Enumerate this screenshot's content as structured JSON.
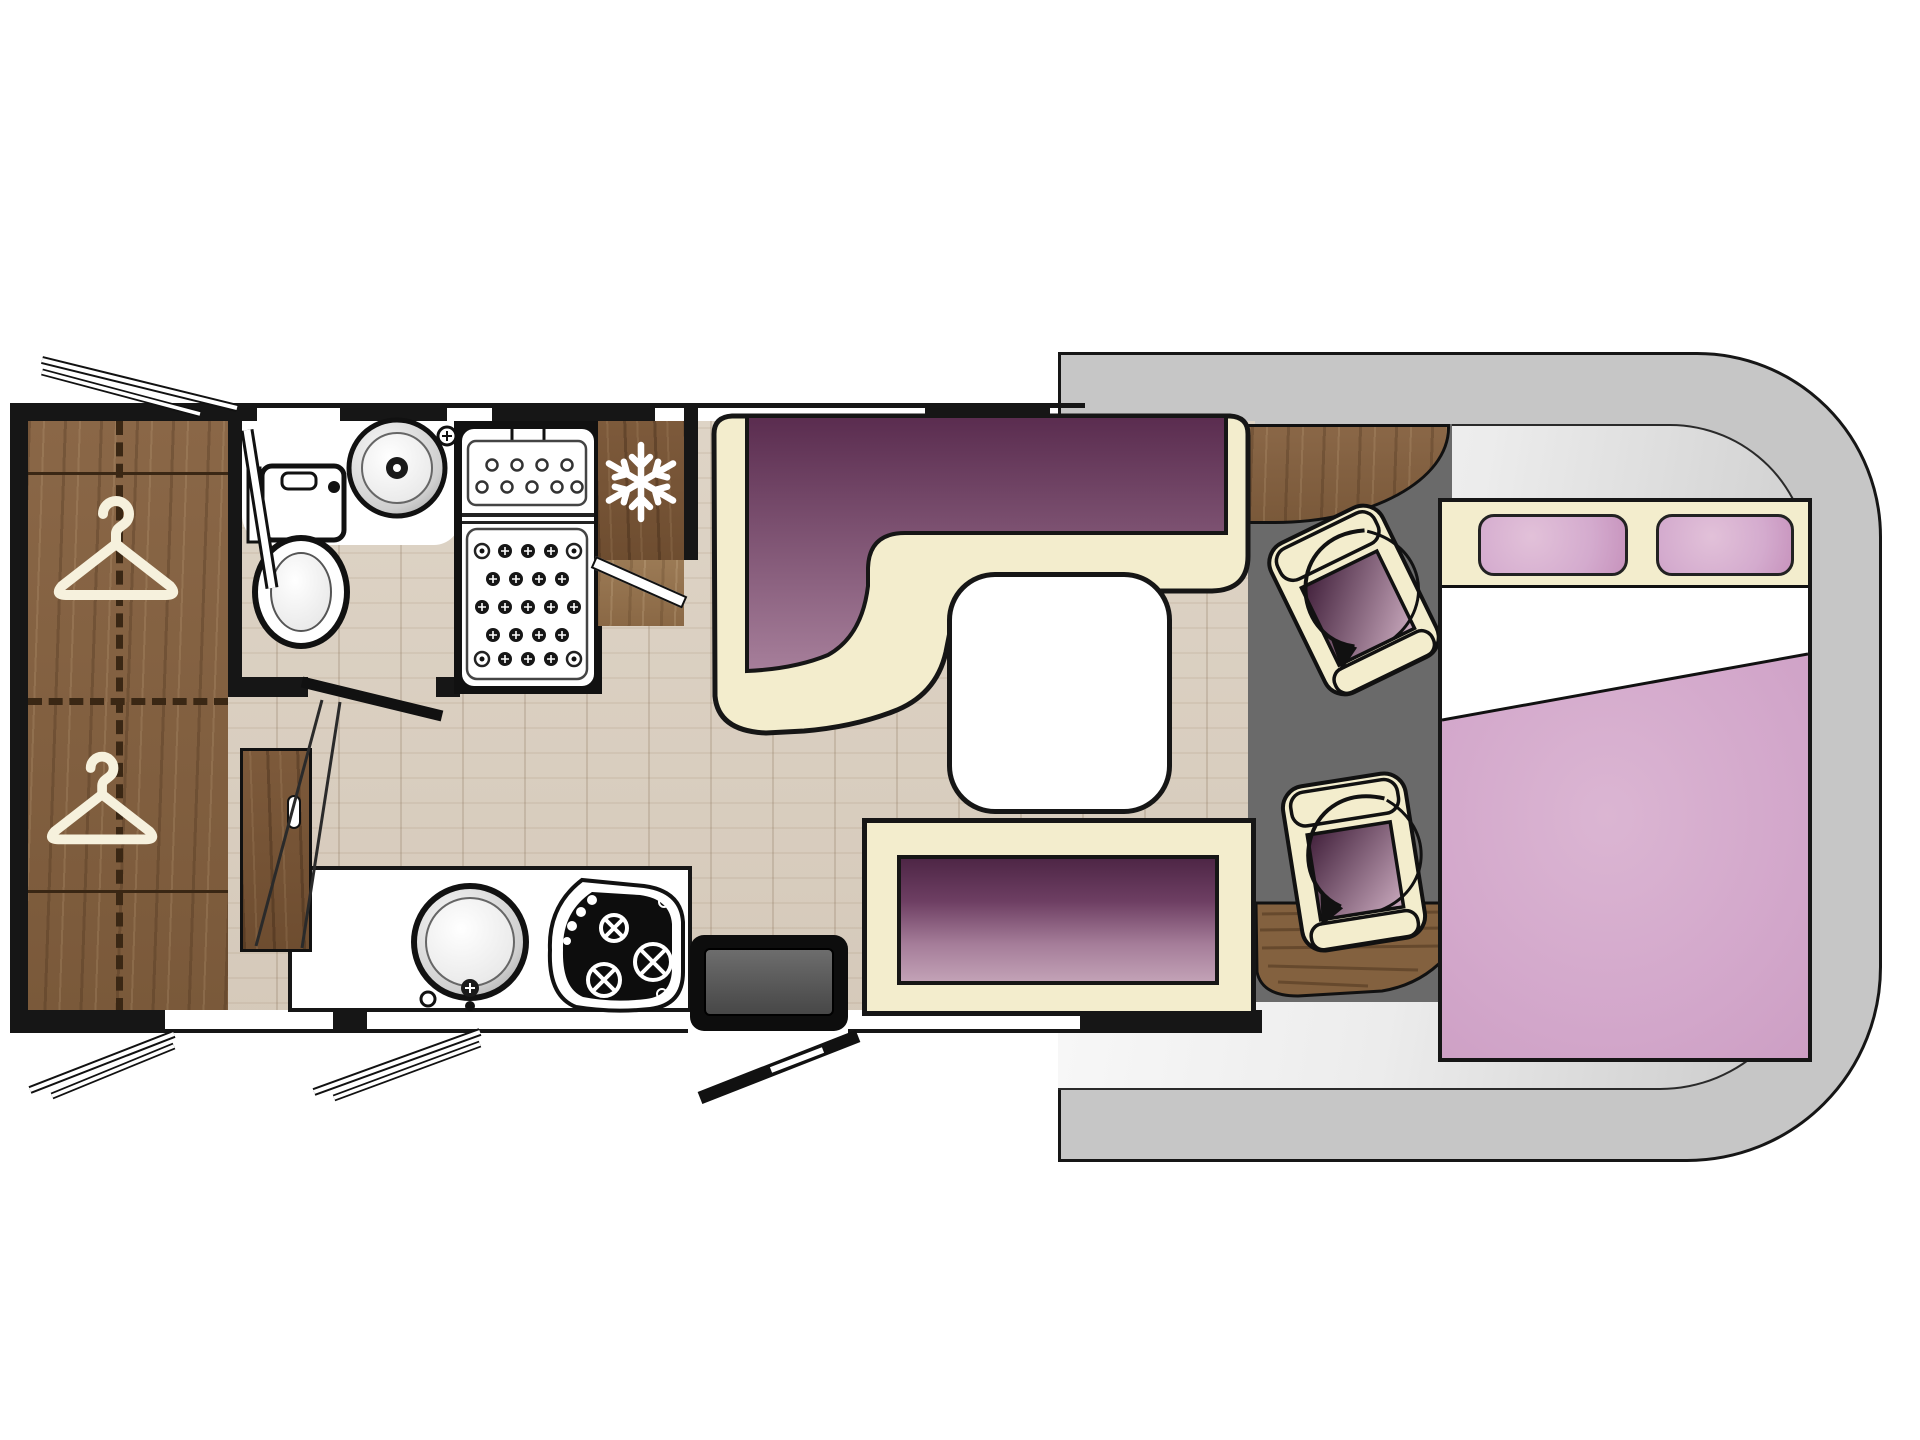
{
  "diagram": {
    "kind": "motorhome-floorplan",
    "view": "top-down",
    "cab_position": "right",
    "visible_text": "none"
  },
  "palette": {
    "outline": "#161616",
    "wood": "#8a6747",
    "woodDark": "#7a593a",
    "woodLight": "#9b7a55",
    "floor": "#d9cfc1",
    "cream": "#f3edcd",
    "purpleDark": "#55294b",
    "purpleMid": "#7d4a6e",
    "purpleLight": "#b793a9",
    "benchDark": "#4e2646",
    "benchLight": "#c2a1b6",
    "cabBody": "#c6c6c6",
    "cabBodyInner": "#f4f4f4",
    "cabFloor": "#6a6a6a",
    "stepGrey": "#575757",
    "bedPink": "#d4a9cc",
    "bedPinkLight": "#e2c1d9",
    "pillowPink": "#d4abce",
    "white": "#ffffff"
  },
  "zones": {
    "wardrobe": {
      "name": "Wardrobe with two hanging rails",
      "icon": "clothes-hanger"
    },
    "bathroom": {
      "name": "Washroom with toilet and round basin"
    },
    "shower": {
      "name": "Shower cubicle with drain tray"
    },
    "fridge": {
      "name": "Refrigerator",
      "icon": "snowflake"
    },
    "kitchen": {
      "name": "Kitchen counter with round sink and 3-burner hob"
    },
    "cabinet": {
      "name": "Low cabinet with handle slot"
    },
    "dinette": {
      "name": "L-shaped lounge seat with purple upholstery"
    },
    "bench": {
      "name": "Side bench seat with purple cushion"
    },
    "table": {
      "name": "Dining table"
    },
    "cab": {
      "name": "Driver cab with two swivel seats",
      "icon": "rotation-arrow"
    },
    "entrance": {
      "name": "Entrance door with entry step"
    },
    "bed": {
      "name": "Double bed with two pillows and duvet"
    },
    "garage": {
      "name": "Exterior hatches and window stays"
    }
  }
}
